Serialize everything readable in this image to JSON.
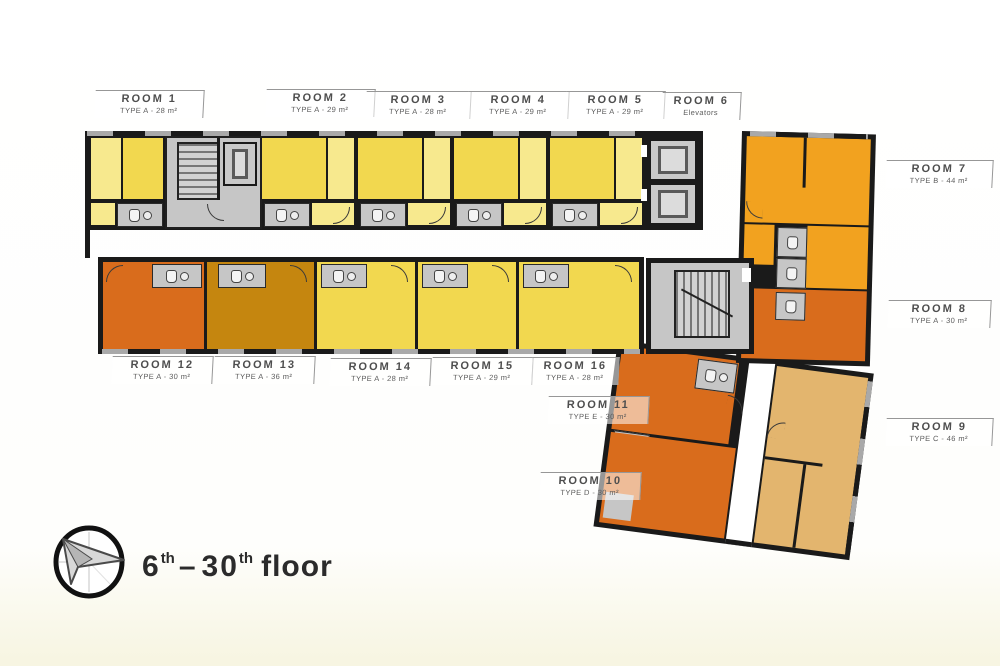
{
  "palette": {
    "wall": "#1a1a1a",
    "yellow": "#f2d84f",
    "yellow_light": "#f7e98e",
    "orange": "#d96c1c",
    "amber": "#c5860f",
    "amber_orange": "#f2a21f",
    "tan": "#e3b56e",
    "gray": "#c6c6c6",
    "ink": "#2b2b2b",
    "label": "#4e4e4e"
  },
  "rooms": [
    {
      "name": "ROOM 1",
      "spec": "TYPE A - 28 m²"
    },
    {
      "name": "ROOM 2",
      "spec": "TYPE A - 29 m²"
    },
    {
      "name": "ROOM 3",
      "spec": "TYPE A - 28 m²"
    },
    {
      "name": "ROOM 4",
      "spec": "TYPE A - 29 m²"
    },
    {
      "name": "ROOM 5",
      "spec": "TYPE A - 29 m²"
    },
    {
      "name": "ROOM 6",
      "spec": "Elevators"
    },
    {
      "name": "ROOM 7",
      "spec": "TYPE B - 44 m²"
    },
    {
      "name": "ROOM 8",
      "spec": "TYPE A - 30 m²"
    },
    {
      "name": "ROOM 9",
      "spec": "TYPE C - 46 m²"
    },
    {
      "name": "ROOM 10",
      "spec": "TYPE D - 30 m²"
    },
    {
      "name": "ROOM 11",
      "spec": "TYPE E - 30 m²"
    },
    {
      "name": "ROOM 12",
      "spec": "TYPE A - 30 m²"
    },
    {
      "name": "ROOM 13",
      "spec": "TYPE A - 36 m²"
    },
    {
      "name": "ROOM 14",
      "spec": "TYPE A - 28 m²"
    },
    {
      "name": "ROOM 15",
      "spec": "TYPE A - 29 m²"
    },
    {
      "name": "ROOM 16",
      "spec": "TYPE A - 28 m²"
    }
  ],
  "floor_label": {
    "from": "6",
    "from_sup": "th",
    "separator": "–",
    "to": "30",
    "to_sup": "th",
    "suffix": "floor"
  }
}
